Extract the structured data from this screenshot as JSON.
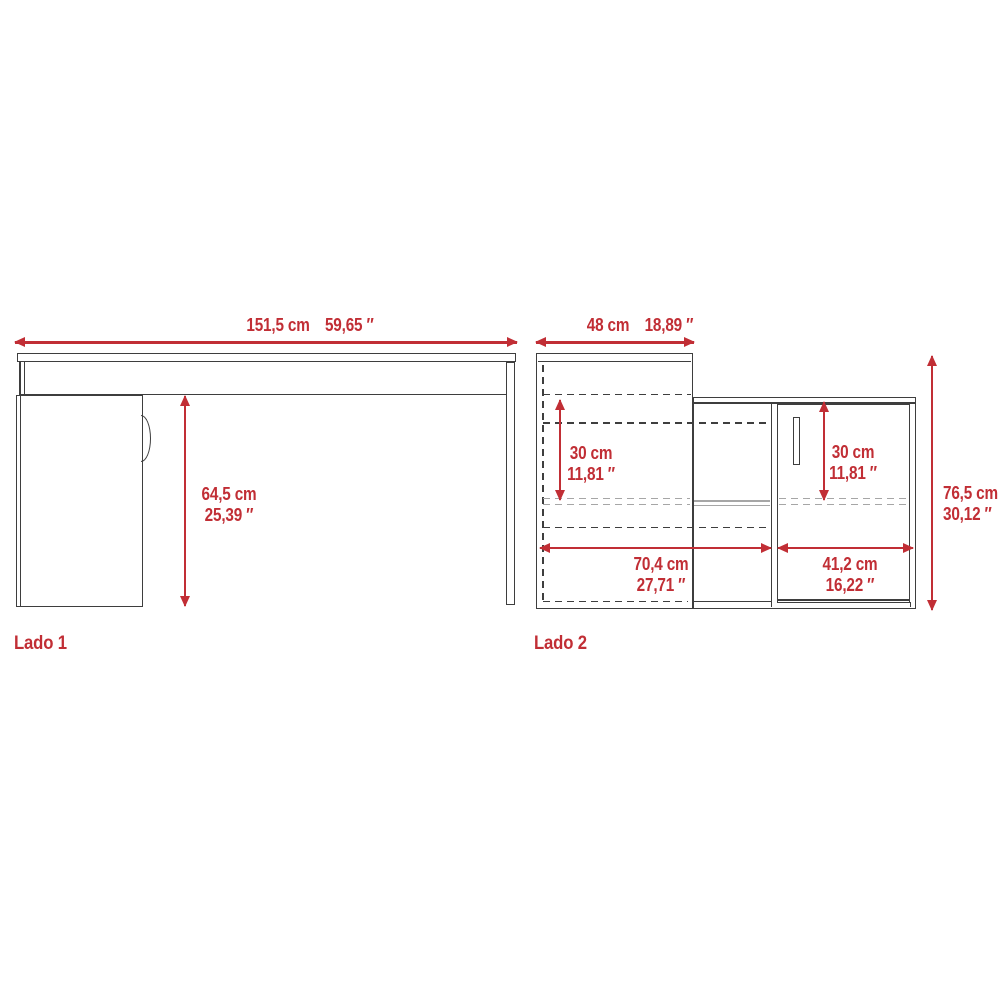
{
  "colors": {
    "background": "#FFFFFF",
    "red": "#C12E35",
    "line": "#3E3E3E",
    "line_gray": "#A6A6A6"
  },
  "lado1": {
    "label": "Lado 1",
    "width_cm": "151,5 cm",
    "width_in": "59,65 ″",
    "height_cm": "64,5 cm",
    "height_in": "25,39 ″"
  },
  "lado2": {
    "label": "Lado 2",
    "depth_cm": "48 cm",
    "depth_in": "18,89 ″",
    "left_opening_cm": "30 cm",
    "left_opening_in": "11,81 ″",
    "door_opening_cm": "30 cm",
    "door_opening_in": "11,81 ″",
    "desk_width_cm": "70,4 cm",
    "desk_width_in": "27,71 ″",
    "cabinet_width_cm": "41,2 cm",
    "cabinet_width_in": "16,22 ″",
    "height_cm": "76,5 cm",
    "height_in": "30,12 ″"
  }
}
